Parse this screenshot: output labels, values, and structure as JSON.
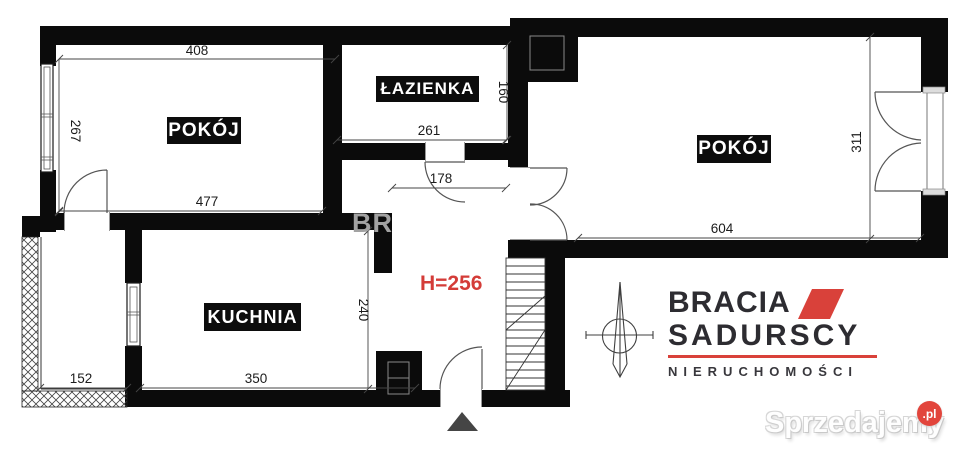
{
  "plan": {
    "rooms": [
      {
        "id": "room-left",
        "label": "POKÓJ"
      },
      {
        "id": "bathroom",
        "label": "ŁAZIENKA"
      },
      {
        "id": "room-right",
        "label": "POKÓJ"
      },
      {
        "id": "kitchen",
        "label": "KUCHNIA"
      }
    ],
    "ceiling_height": "H=256",
    "partial_watermark": "BR",
    "dimensions": {
      "room_left_width": "408",
      "room_left_height": "267",
      "room_left_bottom": "477",
      "bathroom_width": "261",
      "bathroom_height": "160",
      "hall_width": "178",
      "room_right_height": "311",
      "room_right_width": "604",
      "hall_height": "240",
      "balcony_width": "152",
      "kitchen_width": "350"
    }
  },
  "branding": {
    "line1": "BRACIA",
    "line2": "SADURSCY",
    "line3": "NIERUCHOMOŚCI",
    "accent_color": "#d9413a"
  },
  "watermark": {
    "site": "Sprzedajemy",
    "tld": ".pl",
    "badge_color": "#e2453c"
  },
  "colors": {
    "wall": "#0b0b0b",
    "dimension_text": "#1c1c1c",
    "height_text": "#d43c38"
  }
}
